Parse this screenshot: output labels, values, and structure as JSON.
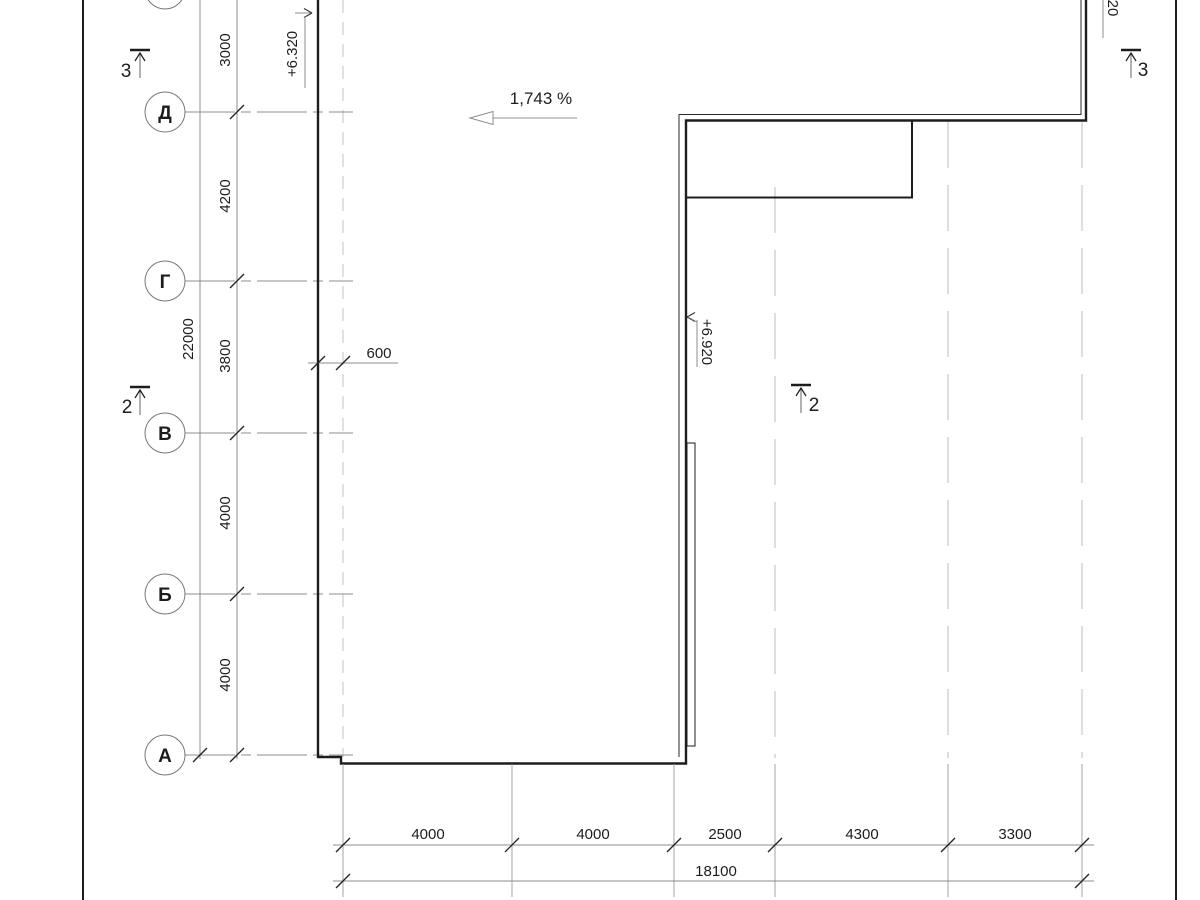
{
  "axes": {
    "row_labels": [
      "Д",
      "Г",
      "В",
      "Б",
      "А"
    ]
  },
  "left_dims": {
    "segments": [
      "3000",
      "4200",
      "3800",
      "4000",
      "4000"
    ],
    "overall": "22000"
  },
  "bottom_dims": {
    "segments": [
      "4000",
      "4000",
      "2500",
      "4300",
      "3300"
    ],
    "overall": "18100"
  },
  "offset_dim": "600",
  "slope_label": "1,743 %",
  "elevations": {
    "left": "+6.320",
    "inner": "+6.920",
    "top_right_partial": "20"
  },
  "sections": {
    "left_top": "3",
    "left_middle": "2",
    "inner": "2",
    "right_top": "3"
  },
  "colors": {
    "line_dark": "#1d1d1d",
    "line_gray": "#8c8c8c",
    "line_light": "#cdcdcd",
    "background": "#ffffff"
  }
}
